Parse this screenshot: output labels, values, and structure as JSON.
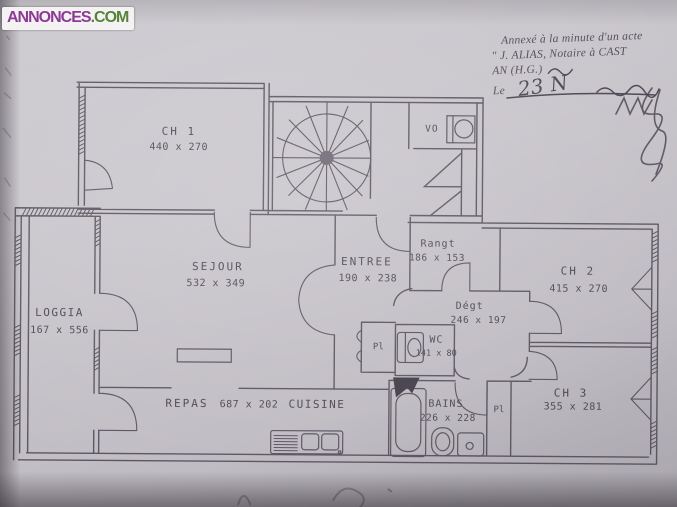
{
  "site_logo": {
    "name": "ANNONCES",
    "tld": ".COM"
  },
  "notary_stamp": {
    "line1": "Annexé à la minute d'un acte",
    "line2": "\" J. ALIAS, Notaire à CAST",
    "line3": "AN (H.G.)",
    "date_label": "Le",
    "date_handwritten": "23 N"
  },
  "rooms": {
    "ch1": {
      "name": "CH 1",
      "dims": "440 x 270"
    },
    "sejour": {
      "name": "SEJOUR",
      "dims": "532 x 349"
    },
    "entree": {
      "name": "ENTREE",
      "dims": "190 x 238"
    },
    "rangt": {
      "name": "Rangt",
      "dims": "186 x 153"
    },
    "ch2": {
      "name": "CH 2",
      "dims": "415 x 270"
    },
    "loggia": {
      "name": "LOGGIA",
      "dims": "167 x 556"
    },
    "degt": {
      "name": "Dégt",
      "dims": "246 x 197"
    },
    "wc": {
      "name": "WC",
      "dims": "141 x 80"
    },
    "repas": {
      "name": "REPAS",
      "dims": "687 x 202"
    },
    "cuisine": {
      "name": "CUISINE"
    },
    "bains": {
      "name": "BAINS",
      "dims": "226 x 228"
    },
    "ch3": {
      "name": "CH 3",
      "dims": "355 x 281"
    },
    "vo": {
      "name": "VO"
    },
    "placard_sejour": {
      "name": "Pl"
    },
    "placard_ch3": {
      "name": "Pl"
    }
  },
  "colors": {
    "plan_line": "#5b5560",
    "paper": "#c8c5cb",
    "label_text": "#4d4752"
  }
}
